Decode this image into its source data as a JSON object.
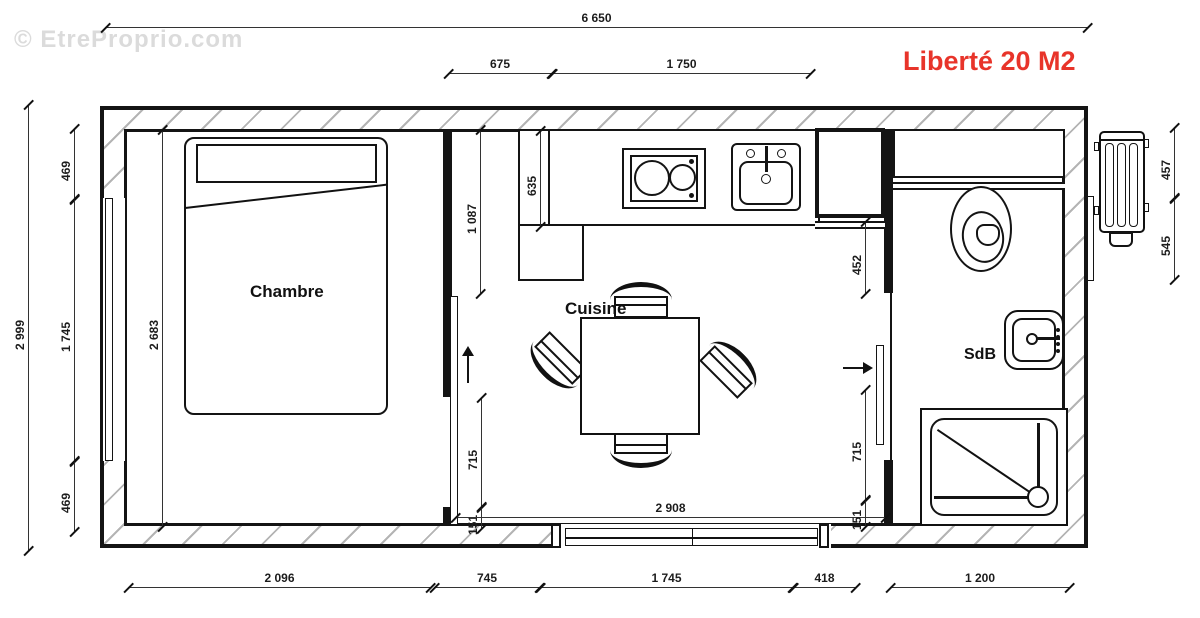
{
  "watermark": "© EtreProprio.com",
  "title": "Liberté 20 M2",
  "rooms": {
    "bedroom": "Chambre",
    "kitchen": "Cuisine",
    "bathroom": "SdB"
  },
  "dims": {
    "top_total": "6 650",
    "top_kitchen_left": "675",
    "top_kitchen_counter": "1 750",
    "left_total": "2 999",
    "left_top": "469",
    "left_window": "1 745",
    "left_bottom": "469",
    "bedroom_interior_height": "2 683",
    "kitchen_left_depth": "1 087",
    "counter_depth": "635",
    "bath_top": "452",
    "left_door_opening": "715",
    "left_door_stub": "151",
    "right_door_opening": "715",
    "right_door_stub": "151",
    "kitchen_width": "2 908",
    "right_heater_top": "457",
    "right_heater_bottom": "545",
    "bottom_bedroom": "2 096",
    "bottom_partition": "745",
    "bottom_slider": "1 745",
    "bottom_418": "418",
    "bottom_bath": "1 200"
  }
}
